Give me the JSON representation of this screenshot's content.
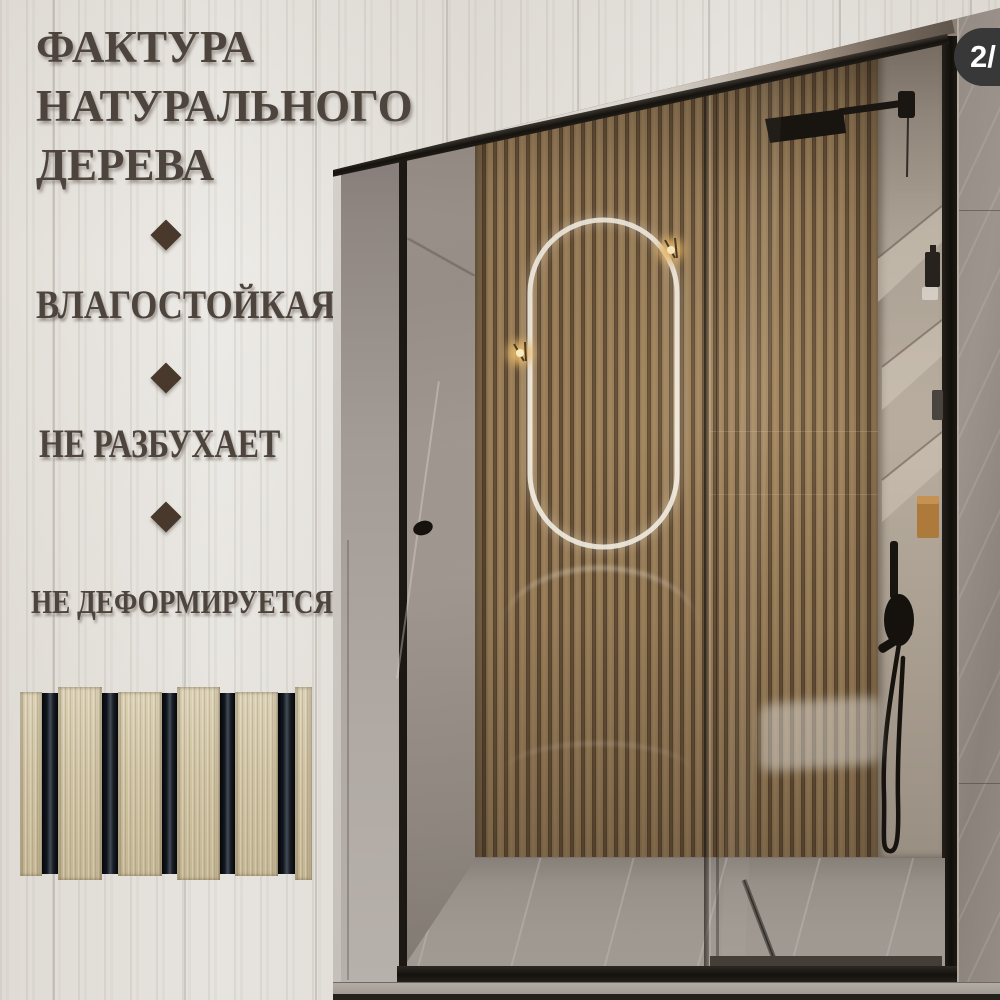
{
  "product_card": {
    "heading_lines": [
      "ФАКТУРА",
      "НАТУРАЛЬНОГО",
      "ДЕРЕВА"
    ],
    "features": [
      {
        "label": "ВЛАГОСТОЙКАЯ"
      },
      {
        "label": "НЕ РАЗБУХАЕТ"
      },
      {
        "label": "НЕ ДЕФОРМИРУЕТСЯ"
      }
    ],
    "separator_icon": "diamond-bullet",
    "text_color": "#4d443e"
  },
  "badge": {
    "label": "2/",
    "background": "#383838",
    "text_color": "#ffffff"
  },
  "palette": {
    "whitewash_background": "#e8e5e1",
    "slat_wood_light": "#a0845d",
    "slat_wood_dark": "#55432e",
    "frame_black": "#1c1915",
    "marble_grey": "#9b938b",
    "sample_slat_beige": "#d0c4a5",
    "sample_groove_black": "#0c0f13",
    "sconce_gold": "#e8b96a"
  }
}
